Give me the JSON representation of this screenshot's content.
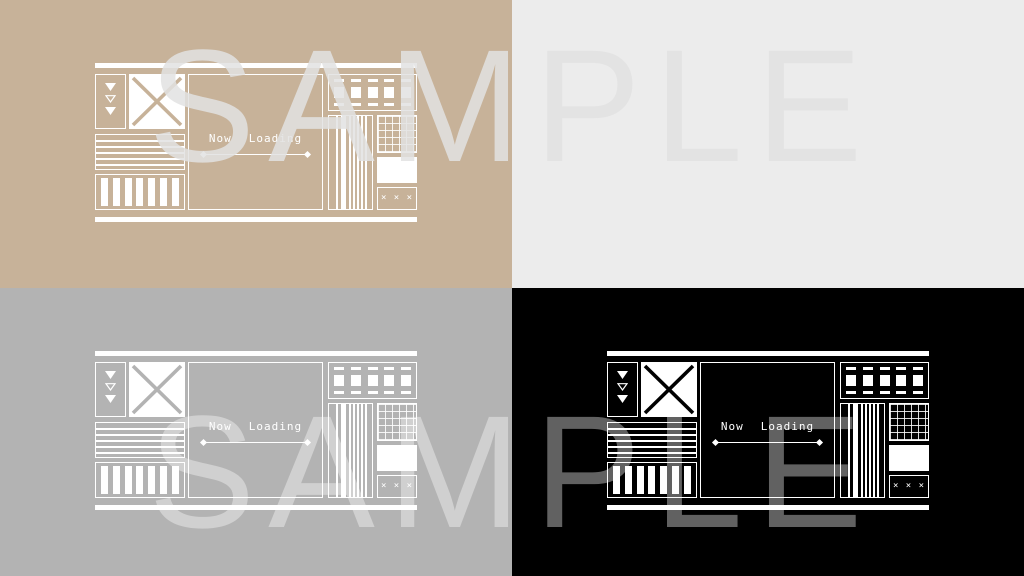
{
  "quadrants": [
    {
      "name": "tan",
      "bg": "#c7b299"
    },
    {
      "name": "light-gray",
      "bg": "#ececec"
    },
    {
      "name": "gray",
      "bg": "#b3b3b3"
    },
    {
      "name": "black",
      "bg": "#000000"
    }
  ],
  "design": {
    "loading_word1": "Now",
    "loading_word2": "Loading",
    "xxx_label": "× × ×",
    "line_color": "#ffffff"
  },
  "watermark": {
    "top": "SAMPLE",
    "bottom": "SAMPLE"
  }
}
